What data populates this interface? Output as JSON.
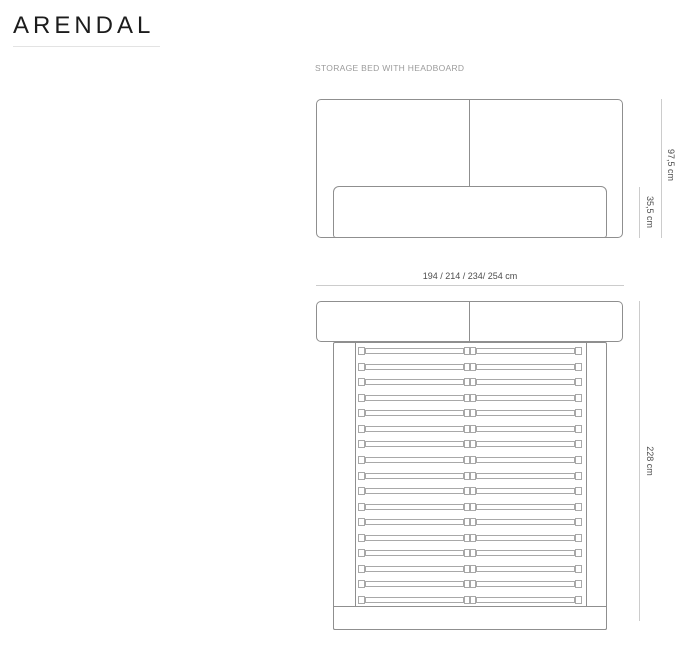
{
  "page": {
    "title": "ARENDAL"
  },
  "diagram": {
    "label": "STORAGE BED WITH HEADBOARD",
    "views": {
      "front": {
        "name": "front elevation of bed with headboard and storage base"
      },
      "top": {
        "name": "top plan of bed frame with slatted base",
        "slat_count": 17
      }
    },
    "dimensions": {
      "total_height": "97,5 cm",
      "base_height": "35,5 cm",
      "width_options": "194 / 214 / 234/ 254 cm",
      "total_length": "228 cm"
    },
    "colors": {
      "outline": "#8f8f8f",
      "slat_outline": "#a8a8a8",
      "dimension_line": "#cccccc",
      "dimension_text": "#4d4d4d",
      "label_text": "#9b9b9b",
      "title_text": "#1c1c1c",
      "underline": "#e3e3e3"
    }
  }
}
